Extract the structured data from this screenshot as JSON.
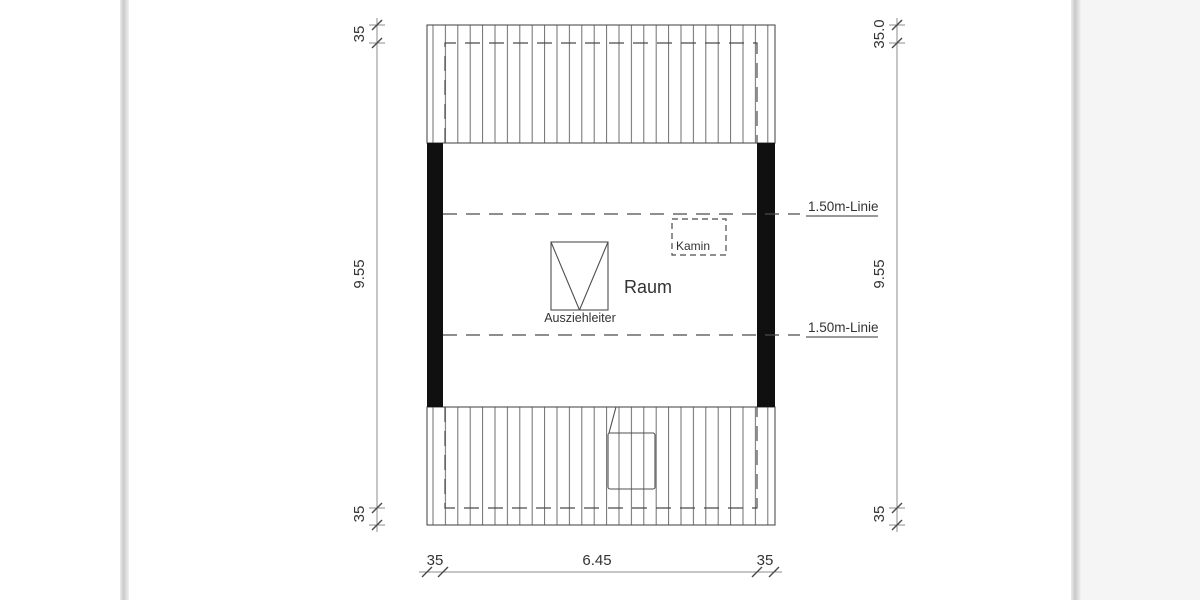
{
  "plan": {
    "room_label": "Raum",
    "ladder_label": "Ausziehleiter",
    "chimney_label": "Kamin",
    "headroom_line_top_label": "1.50m-Linie",
    "headroom_line_bottom_label": "1.50m-Linie"
  },
  "dimensions": {
    "left_top": "35",
    "left_height": "9.55",
    "left_bottom": "35",
    "right_top": "35.0",
    "right_height": "9.55",
    "right_bottom": "35",
    "bottom_left_eave": "35",
    "bottom_width": "6.45",
    "bottom_right_eave": "35"
  },
  "colors": {
    "wall_fill": "#101010",
    "outline": "#4f4f4f",
    "hatch_line": "#6e6e6e",
    "dimension_line": "#8c8c8c",
    "dashed_line": "#4a4a4a",
    "text": "#333333",
    "page_edge": "#c9c9c9",
    "right_margin_bg": "#f5f5f5"
  }
}
